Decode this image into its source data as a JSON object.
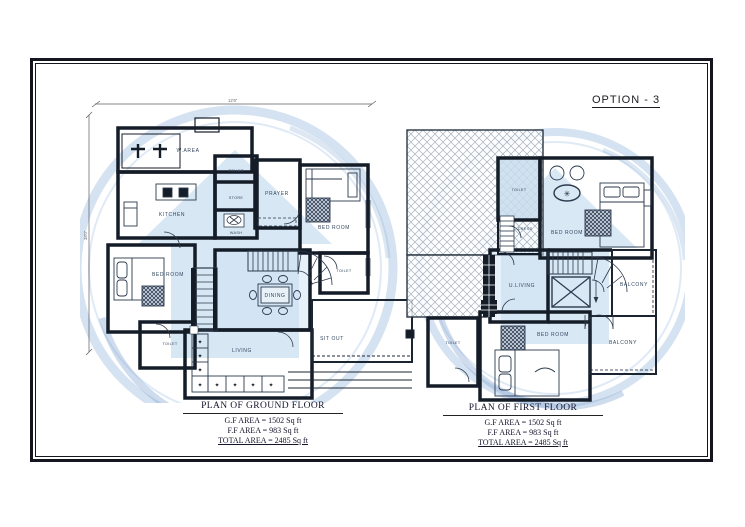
{
  "option_label": "OPTION - 3",
  "colors": {
    "wall": "#141c28",
    "watermark_circle": "#aac6e4",
    "watermark_house": "#bfd8ee",
    "room_tint": "#cfe4f4",
    "label_text": "#35485f"
  },
  "ground_floor": {
    "title": "PLAN OF GROUND FLOOR",
    "area_lines": [
      "G.F AREA =  1502 Sq ft",
      "F.F AREA =  983 Sq ft",
      "TOTAL AREA =  2485 Sq ft"
    ],
    "dim_width": "12'6\"",
    "dim_height": "38'0\"",
    "labels": {
      "w_area": "W.AREA",
      "kitchen": "KITCHEN",
      "toilet_mid": "TOILET",
      "store": "STORE",
      "wash": "WASH",
      "prayer": "PRAYER",
      "bed_top": "BED ROOM",
      "toilet_right": "TOILET",
      "bed_left": "BED ROOM",
      "toilet_left": "TOILET",
      "dining": "DINING",
      "living": "LIVING",
      "sit_out": "SIT OUT"
    }
  },
  "first_floor": {
    "title": "PLAN OF FIRST FLOOR",
    "area_lines": [
      "G.F AREA =  1502 Sq ft",
      "F.F AREA =  983 Sq ft",
      "TOTAL AREA =  2485 Sq ft"
    ],
    "labels": {
      "toilet_top": "TOILET",
      "dress": "DRESS",
      "bed_top": "BED ROOM",
      "u_living": "U.LIVING",
      "balcony_mid": "BALCONY",
      "balcony_btm": "BALCONY",
      "bed_btm": "BED ROOM",
      "toilet_btm": "TOILET"
    }
  }
}
